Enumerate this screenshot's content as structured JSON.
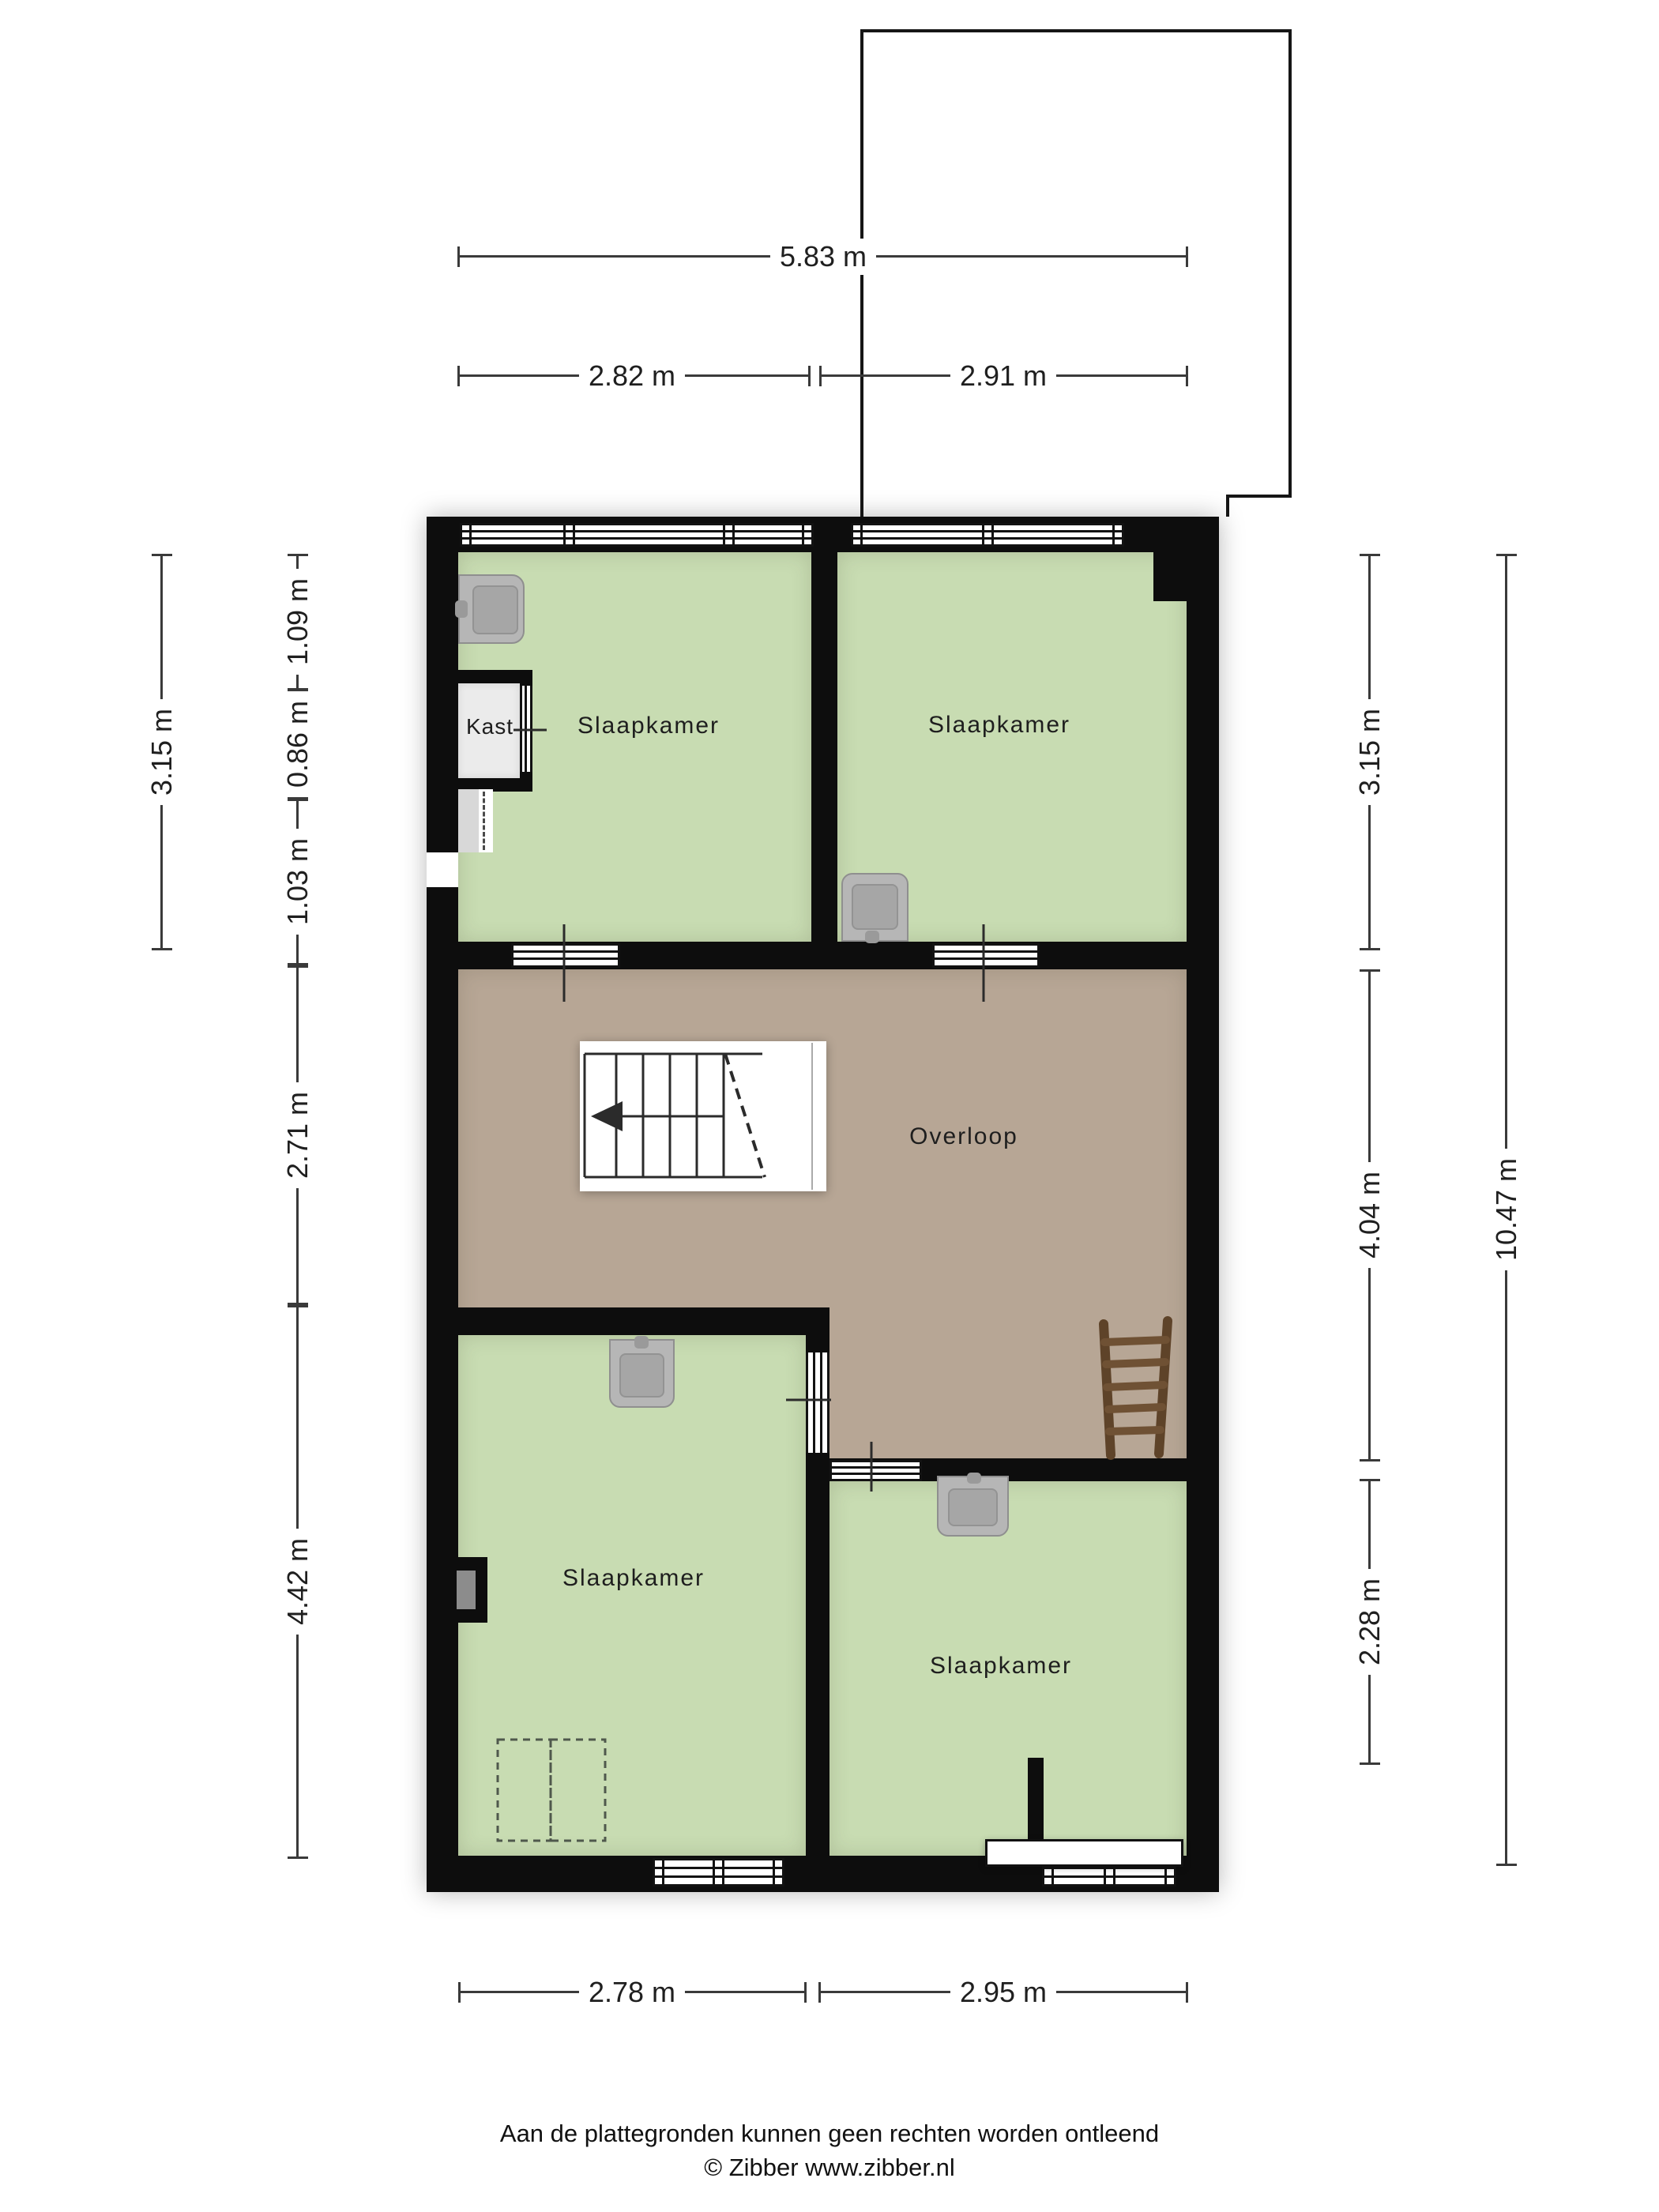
{
  "rooms": {
    "bedroom_top_left": "Slaapkamer",
    "bedroom_top_right": "Slaapkamer",
    "bedroom_bottom_left": "Slaapkamer",
    "bedroom_bottom_right": "Slaapkamer",
    "closet": "Kast",
    "landing": "Overloop"
  },
  "dimensions": {
    "top_total": "5.83 m",
    "top_left": "2.82 m",
    "top_right": "2.91 m",
    "left_outer": "3.15 m",
    "left_1": "1.09 m",
    "left_2": "0.86 m",
    "left_3": "1.03 m",
    "left_4": "2.71 m",
    "left_5": "4.42 m",
    "right_1": "3.15 m",
    "right_2": "4.04 m",
    "right_3": "2.28 m",
    "right_outer": "10.47 m",
    "bottom_left": "2.78 m",
    "bottom_right": "2.95 m"
  },
  "footer": {
    "line1": "Aan de plattegronden kunnen geen rechten worden ontleend",
    "line2": "© Zibber www.zibber.nl"
  },
  "colors": {
    "room_green": "#c8dcb2",
    "landing_tan": "#b7a695",
    "wall_black": "#0d0d0d",
    "closet_gray": "#ebebeb",
    "dimension_line": "#3a3a3a",
    "ladder_brown": "#5e4329"
  }
}
